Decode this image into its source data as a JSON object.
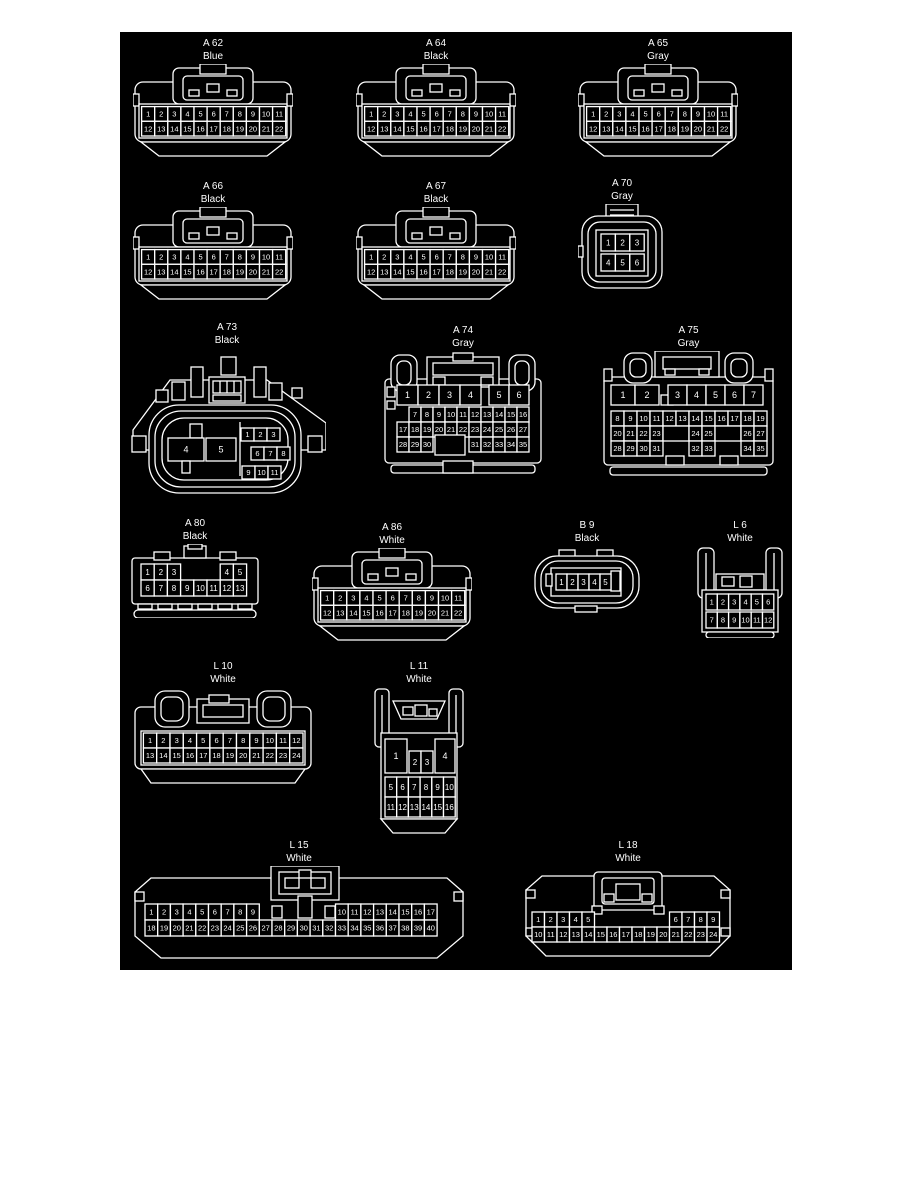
{
  "page": {
    "background": "#ffffff",
    "canvas_background": "#000000",
    "line_color": "#ffffff"
  },
  "connectors": [
    {
      "id": "A 62",
      "color": "Blue",
      "pins": [
        [
          "1",
          "2",
          "3",
          "4",
          "5",
          "6",
          "7",
          "8",
          "9",
          "10",
          "11"
        ],
        [
          "12",
          "13",
          "14",
          "15",
          "16",
          "17",
          "18",
          "19",
          "20",
          "21",
          "22"
        ]
      ]
    },
    {
      "id": "A 64",
      "color": "Black",
      "pins": [
        [
          "1",
          "2",
          "3",
          "4",
          "5",
          "6",
          "7",
          "8",
          "9",
          "10",
          "11"
        ],
        [
          "12",
          "13",
          "14",
          "15",
          "16",
          "17",
          "18",
          "19",
          "20",
          "21",
          "22"
        ]
      ]
    },
    {
      "id": "A 65",
      "color": "Gray",
      "pins": [
        [
          "1",
          "2",
          "3",
          "4",
          "5",
          "6",
          "7",
          "8",
          "9",
          "10",
          "11"
        ],
        [
          "12",
          "13",
          "14",
          "15",
          "16",
          "17",
          "18",
          "19",
          "20",
          "21",
          "22"
        ]
      ]
    },
    {
      "id": "A 66",
      "color": "Black",
      "pins": [
        [
          "1",
          "2",
          "3",
          "4",
          "5",
          "6",
          "7",
          "8",
          "9",
          "10",
          "11"
        ],
        [
          "12",
          "13",
          "14",
          "15",
          "16",
          "17",
          "18",
          "19",
          "20",
          "21",
          "22"
        ]
      ]
    },
    {
      "id": "A 67",
      "color": "Black",
      "pins": [
        [
          "1",
          "2",
          "3",
          "4",
          "5",
          "6",
          "7",
          "8",
          "9",
          "10",
          "11"
        ],
        [
          "12",
          "13",
          "14",
          "15",
          "16",
          "17",
          "18",
          "19",
          "20",
          "21",
          "22"
        ]
      ]
    },
    {
      "id": "A 70",
      "color": "Gray",
      "pins": [
        [
          "1",
          "2",
          "3"
        ],
        [
          "4",
          "5",
          "6"
        ]
      ]
    },
    {
      "id": "A 73",
      "color": "Black",
      "pins": [
        [
          "4",
          "5"
        ],
        [
          "1",
          "2",
          "3"
        ],
        [
          "6",
          "7",
          "8"
        ],
        [
          "9",
          "10",
          "11"
        ]
      ]
    },
    {
      "id": "A 74",
      "color": "Gray",
      "pins": [
        [
          "1",
          "2",
          "3",
          "4"
        ],
        [
          "5",
          "6"
        ],
        [
          "_",
          "7",
          "8",
          "9",
          "10",
          "11",
          "12",
          "13",
          "14",
          "15",
          "16"
        ],
        [
          "17",
          "18",
          "19",
          "20",
          "21",
          "22",
          "23",
          "24",
          "25",
          "26",
          "27"
        ],
        [
          "28",
          "29",
          "30",
          "_",
          "_",
          "_",
          "31",
          "32",
          "33",
          "34",
          "35"
        ]
      ]
    },
    {
      "id": "A 75",
      "color": "Gray",
      "pins": [
        [
          "1",
          "2"
        ],
        [
          "3",
          "4",
          "5",
          "6",
          "7"
        ],
        [
          "8",
          "9",
          "10",
          "11",
          "12",
          "13",
          "14",
          "15",
          "16",
          "17",
          "18",
          "19"
        ],
        [
          "20",
          "21",
          "22",
          "23",
          "##",
          "24",
          "25",
          "##",
          "26",
          "27"
        ],
        [
          "28",
          "29",
          "30",
          "31",
          "_",
          "_",
          "32",
          "33",
          "_",
          "_",
          "34",
          "35"
        ]
      ]
    },
    {
      "id": "A 80",
      "color": "Black",
      "pins": [
        [
          "1",
          "2",
          "3",
          "_",
          "_",
          "_",
          "4",
          "5"
        ],
        [
          "6",
          "7",
          "8",
          "9",
          "10",
          "11",
          "12",
          "13"
        ]
      ]
    },
    {
      "id": "A 86",
      "color": "White",
      "pins": [
        [
          "1",
          "2",
          "3",
          "4",
          "5",
          "6",
          "7",
          "8",
          "9",
          "10",
          "11"
        ],
        [
          "12",
          "13",
          "14",
          "15",
          "16",
          "17",
          "18",
          "19",
          "20",
          "21",
          "22"
        ]
      ]
    },
    {
      "id": "B 9",
      "color": "Black",
      "pins": [
        [
          "1",
          "2",
          "3",
          "4",
          "5"
        ]
      ]
    },
    {
      "id": "L 6",
      "color": "White",
      "pins": [
        [
          "1",
          "2",
          "3",
          "4",
          "5",
          "6"
        ],
        [
          "7",
          "8",
          "9",
          "10",
          "11",
          "12"
        ]
      ]
    },
    {
      "id": "L 10",
      "color": "White",
      "pins": [
        [
          "1",
          "2",
          "3",
          "4",
          "5",
          "6",
          "7",
          "8",
          "9",
          "10",
          "11",
          "12"
        ],
        [
          "13",
          "14",
          "15",
          "16",
          "17",
          "18",
          "19",
          "20",
          "21",
          "22",
          "23",
          "24"
        ]
      ]
    },
    {
      "id": "L 11",
      "color": "White",
      "pins": [
        [
          "1"
        ],
        [
          "2",
          "3"
        ],
        [
          "4"
        ],
        [
          "5",
          "6",
          "7",
          "8",
          "9",
          "10"
        ],
        [
          "11",
          "12",
          "13",
          "14",
          "15",
          "16"
        ]
      ]
    },
    {
      "id": "L 15",
      "color": "White",
      "pins": [
        [
          "1",
          "2",
          "3",
          "4",
          "5",
          "6",
          "7",
          "8",
          "9",
          "_",
          "_",
          "_",
          "_",
          "_",
          "_",
          "10",
          "11",
          "12",
          "13",
          "14",
          "15",
          "16",
          "17"
        ],
        [
          "18",
          "19",
          "20",
          "21",
          "22",
          "23",
          "24",
          "25",
          "26",
          "27",
          "28",
          "29",
          "30",
          "31",
          "32",
          "33",
          "34",
          "35",
          "36",
          "37",
          "38",
          "39",
          "40"
        ]
      ]
    },
    {
      "id": "L 18",
      "color": "White",
      "pins": [
        [
          "1",
          "2",
          "3",
          "4",
          "5",
          "_",
          "_",
          "_",
          "_",
          "_",
          "_",
          "6",
          "7",
          "8",
          "9"
        ],
        [
          "10",
          "11",
          "12",
          "13",
          "14",
          "15",
          "16",
          "17",
          "18",
          "19",
          "20",
          "21",
          "22",
          "23",
          "24"
        ]
      ]
    }
  ]
}
